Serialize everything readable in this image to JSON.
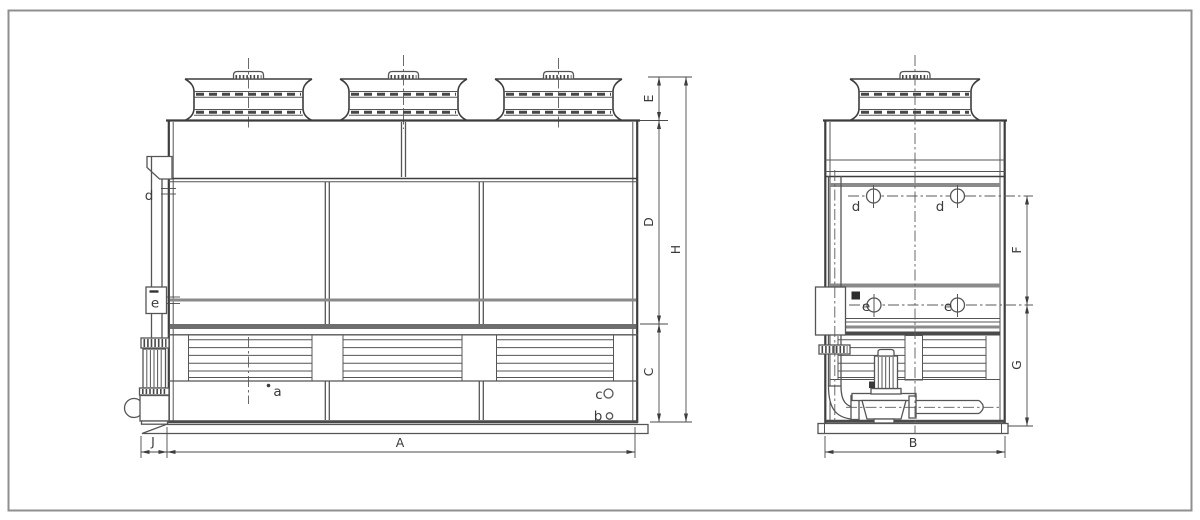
{
  "colors": {
    "background": "#ffffff",
    "border": "#8f8f8f",
    "line": "#3d3d3d",
    "thin": "#555555",
    "band_gray": "#8a8a8a",
    "band_dark": "#6e6e6e",
    "label": "#3a3a3a"
  },
  "front_view": {
    "dims": {
      "A": "A",
      "C": "C",
      "D": "D",
      "E": "E",
      "H": "H",
      "J": "J"
    },
    "connections": {
      "a": "a",
      "b": "b",
      "c": "c",
      "d": "d",
      "e": "e"
    }
  },
  "side_view": {
    "dims": {
      "B": "B",
      "F": "F",
      "G": "G"
    },
    "connections": {
      "d": "d",
      "e": "e"
    }
  }
}
